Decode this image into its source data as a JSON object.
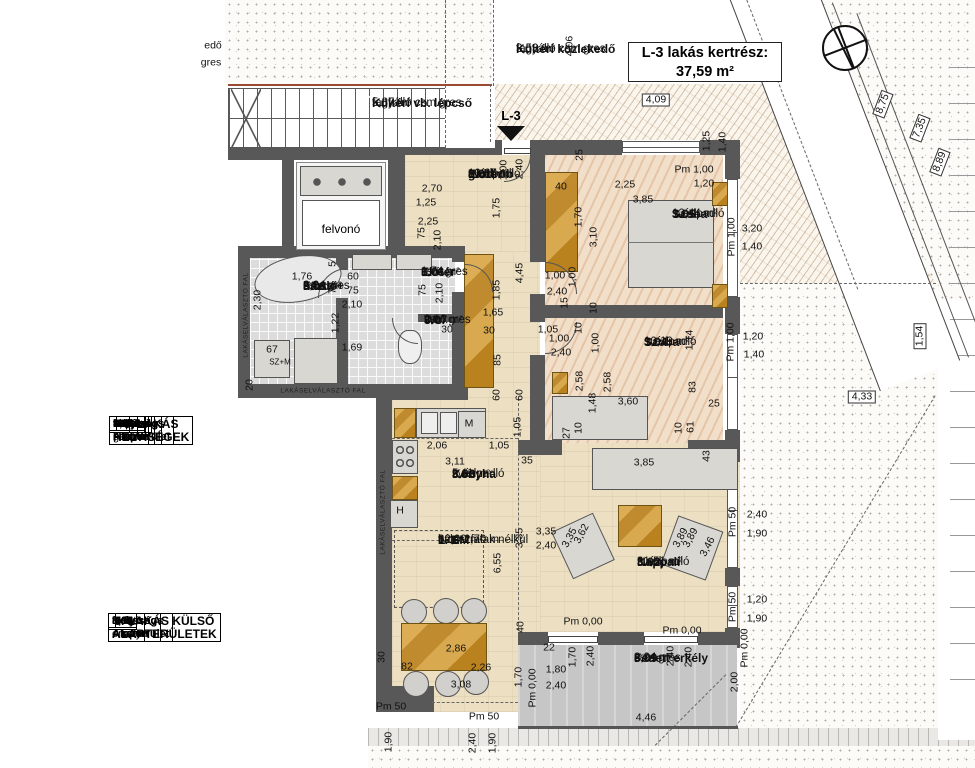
{
  "drawing": {
    "title_box": {
      "line1": "L-3 lakás kertrész:",
      "line2": "37,59 m²"
    },
    "entry_label": "L-3",
    "elevator_label": "felvonó"
  },
  "room_labels": [
    {
      "x": 516,
      "y": 42,
      "bg": 1,
      "lines": [
        [
          "Kültéri közlekedő",
          1
        ],
        [
          "fagyálló csm.gres",
          0
        ],
        [
          "3,53 m²",
          0
        ]
      ]
    },
    {
      "x": 372,
      "y": 96,
      "bg": 1,
      "lines": [
        [
          "Kültéri vb. lépcső",
          1
        ],
        [
          "fagyálló csm.gres",
          0
        ],
        [
          "5,87 m²",
          0
        ]
      ]
    },
    {
      "x": 468,
      "y": 168,
      "bg": 0,
      "lines": [
        [
          "3.01",
          1
        ],
        [
          "Előtér-",
          1
        ],
        [
          "gardrób",
          1
        ],
        [
          "svédpadló",
          0
        ],
        [
          "10,67 m²",
          0
        ]
      ]
    },
    {
      "x": 672,
      "y": 208,
      "bg": 0,
      "lines": [
        [
          "3.05",
          1
        ],
        [
          "Szoba",
          1
        ],
        [
          "svédpadló",
          0
        ],
        [
          "12,44 m²",
          0
        ]
      ]
    },
    {
      "x": 644,
      "y": 336,
      "bg": 0,
      "lines": [
        [
          "3.04",
          1
        ],
        [
          "Szoba",
          1
        ],
        [
          "svédpadló",
          0
        ],
        [
          "10,19 m²",
          0
        ]
      ]
    },
    {
      "x": 303,
      "y": 280,
      "bg": 0,
      "lines": [
        [
          "3.08",
          1
        ],
        [
          "Fürdő+",
          1
        ],
        [
          "házt.",
          1
        ],
        [
          "csm.gres",
          0
        ],
        [
          "6,64 m²",
          0
        ]
      ]
    },
    {
      "x": 421,
      "y": 266,
      "bg": 0,
      "lines": [
        [
          "3.06",
          1
        ],
        [
          "Előtér",
          1
        ],
        [
          "csm.gres",
          0
        ],
        [
          "1,74 m²",
          0
        ]
      ]
    },
    {
      "x": 424,
      "y": 314,
      "bg": 0,
      "lines": [
        [
          "3.07",
          1
        ],
        [
          "Wc",
          1
        ],
        [
          "csm.gres",
          0
        ],
        [
          "2,16 m²",
          0
        ]
      ]
    },
    {
      "x": 452,
      "y": 468,
      "bg": 0,
      "lines": [
        [
          "3.03",
          1
        ],
        [
          "Konyha",
          1
        ],
        [
          "svédpadló",
          0
        ],
        [
          "5,11 m²",
          0
        ]
      ]
    },
    {
      "x": 637,
      "y": 556,
      "bg": 0,
      "lines": [
        [
          "3.02",
          1
        ],
        [
          "Nappali",
          1
        ],
        [
          "svédpadló",
          0
        ],
        [
          "31,51 m²",
          0
        ]
      ]
    },
    {
      "x": 634,
      "y": 652,
      "bg": 0,
      "lines": [
        [
          "3.09",
          1
        ],
        [
          "Fedett erkély",
          1
        ],
        [
          "csm.gres",
          0
        ],
        [
          "8,94 m²",
          0
        ]
      ]
    },
    {
      "x": 438,
      "y": 534,
      "bg": 0,
      "lines": [
        [
          "1. EM",
          1
        ],
        [
          "L-3",
          1
        ],
        [
          "válaszfalak nélkül",
          0
        ],
        [
          "82,99 m²",
          0
        ],
        [
          "bm= 2,70 m",
          0
        ]
      ]
    }
  ],
  "dims": [
    [
      "edő",
      213,
      46,
      "h"
    ],
    [
      "gres",
      211,
      63,
      "h"
    ],
    [
      "4,09",
      656,
      100,
      "hb"
    ],
    [
      "4,06",
      570,
      46,
      "v"
    ],
    [
      "1,25",
      707,
      141,
      "v"
    ],
    [
      "1,40",
      723,
      142,
      "v"
    ],
    [
      "Pm 1,00",
      694,
      170,
      "h"
    ],
    [
      "2,25",
      625,
      185,
      "h"
    ],
    [
      "1,20",
      704,
      184,
      "h"
    ],
    [
      "40",
      561,
      187,
      "h"
    ],
    [
      "3,85",
      643,
      200,
      "h"
    ],
    [
      "3,20",
      752,
      229,
      "h"
    ],
    [
      "1,40",
      752,
      247,
      "h"
    ],
    [
      "25",
      580,
      155,
      "v"
    ],
    [
      "1,00",
      504,
      170,
      "v"
    ],
    [
      "2,40",
      520,
      169,
      "v"
    ],
    [
      "1,75",
      497,
      208,
      "v"
    ],
    [
      "2,70",
      432,
      189,
      "h"
    ],
    [
      "1,25",
      426,
      203,
      "h"
    ],
    [
      "2,25",
      428,
      222,
      "h"
    ],
    [
      "75",
      422,
      233,
      "v"
    ],
    [
      "2,10",
      438,
      240,
      "v"
    ],
    [
      "1,70",
      579,
      217,
      "v"
    ],
    [
      "3,10",
      594,
      237,
      "v"
    ],
    [
      "Pm 1,00",
      732,
      237,
      "v"
    ],
    [
      "1,00",
      555,
      276,
      "h"
    ],
    [
      "2,40",
      557,
      292,
      "h"
    ],
    [
      "1,00",
      573,
      277,
      "v"
    ],
    [
      "15",
      565,
      303,
      "v"
    ],
    [
      "10",
      594,
      308,
      "v"
    ],
    [
      "1,76",
      302,
      277,
      "h"
    ],
    [
      "60",
      353,
      277,
      "h"
    ],
    [
      "75",
      353,
      291,
      "h"
    ],
    [
      "2,10",
      352,
      305,
      "h"
    ],
    [
      "2,30",
      258,
      300,
      "v"
    ],
    [
      "5",
      333,
      264,
      "v"
    ],
    [
      "75",
      333,
      288,
      "v"
    ],
    [
      "1,22",
      336,
      323,
      "v"
    ],
    [
      "20",
      250,
      385,
      "v"
    ],
    [
      "67",
      272,
      350,
      "h"
    ],
    [
      "SZ+M",
      280,
      362,
      "sm"
    ],
    [
      "1,69",
      352,
      348,
      "h"
    ],
    [
      "75",
      423,
      290,
      "v"
    ],
    [
      "2,10",
      440,
      293,
      "v"
    ],
    [
      "30",
      447,
      330,
      "h"
    ],
    [
      "4,45",
      520,
      273,
      "v"
    ],
    [
      "1,85",
      497,
      290,
      "v"
    ],
    [
      "1,65",
      493,
      313,
      "h"
    ],
    [
      "30",
      489,
      331,
      "h"
    ],
    [
      "85",
      498,
      360,
      "v"
    ],
    [
      "60",
      497,
      395,
      "v"
    ],
    [
      "60",
      520,
      395,
      "v"
    ],
    [
      "1,05",
      518,
      427,
      "v"
    ],
    [
      "1,05",
      548,
      330,
      "h"
    ],
    [
      "1,00",
      559,
      339,
      "h"
    ],
    [
      "2,40",
      561,
      353,
      "h"
    ],
    [
      "10",
      579,
      328,
      "v"
    ],
    [
      "1,00",
      596,
      343,
      "v"
    ],
    [
      "2,58",
      580,
      381,
      "v"
    ],
    [
      "2,58",
      608,
      382,
      "v"
    ],
    [
      "1,48",
      593,
      403,
      "v"
    ],
    [
      "3,60",
      628,
      402,
      "h"
    ],
    [
      "1,14",
      690,
      340,
      "v"
    ],
    [
      "83",
      693,
      387,
      "v"
    ],
    [
      "25",
      714,
      404,
      "h"
    ],
    [
      "1,20",
      753,
      337,
      "h"
    ],
    [
      "1,40",
      754,
      355,
      "h"
    ],
    [
      "Pm 1,00",
      731,
      342,
      "v"
    ],
    [
      "27",
      567,
      433,
      "v"
    ],
    [
      "10",
      579,
      428,
      "v"
    ],
    [
      "10",
      679,
      428,
      "v"
    ],
    [
      "61",
      691,
      427,
      "v"
    ],
    [
      "43",
      707,
      456,
      "v"
    ],
    [
      "2,06",
      437,
      446,
      "h"
    ],
    [
      "1,05",
      499,
      446,
      "h"
    ],
    [
      "3,11",
      455,
      462,
      "h"
    ],
    [
      "35",
      527,
      461,
      "h"
    ],
    [
      "M",
      469,
      424,
      "h"
    ],
    [
      "H",
      400,
      511,
      "h"
    ],
    [
      "3,85",
      644,
      463,
      "h"
    ],
    [
      "3,35",
      546,
      532,
      "h"
    ],
    [
      "2,40",
      546,
      546,
      "h"
    ],
    [
      "3,35",
      520,
      538,
      "v"
    ],
    [
      "6,55",
      498,
      563,
      "v"
    ],
    [
      "3,35",
      570,
      538,
      "a"
    ],
    [
      "3,62",
      582,
      534,
      "a"
    ],
    [
      "3,89",
      681,
      538,
      "a"
    ],
    [
      "3,89",
      691,
      538,
      "a"
    ],
    [
      "3,46",
      708,
      547,
      "a"
    ],
    [
      "Pm 50",
      733,
      522,
      "v"
    ],
    [
      "2,40",
      757,
      515,
      "h"
    ],
    [
      "1,90",
      757,
      534,
      "h"
    ],
    [
      "Pm 50",
      733,
      607,
      "v"
    ],
    [
      "1,20",
      757,
      600,
      "h"
    ],
    [
      "1,90",
      757,
      619,
      "h"
    ],
    [
      "Pm 0,00",
      583,
      622,
      "h"
    ],
    [
      "Pm 0,00",
      682,
      631,
      "h"
    ],
    [
      "2,86",
      456,
      649,
      "h"
    ],
    [
      "82",
      407,
      667,
      "h"
    ],
    [
      "2,26",
      481,
      668,
      "h"
    ],
    [
      "3,08",
      461,
      685,
      "h"
    ],
    [
      "30",
      382,
      657,
      "v"
    ],
    [
      "Pm 50",
      391,
      707,
      "h"
    ],
    [
      "Pm 50",
      484,
      717,
      "h"
    ],
    [
      "40",
      521,
      627,
      "v"
    ],
    [
      "22",
      549,
      648,
      "h"
    ],
    [
      "1,70",
      573,
      657,
      "v"
    ],
    [
      "2,40",
      591,
      656,
      "v"
    ],
    [
      "1,80",
      556,
      670,
      "h"
    ],
    [
      "2,40",
      556,
      686,
      "h"
    ],
    [
      "1,70",
      519,
      677,
      "v"
    ],
    [
      "Pm 0,00",
      533,
      688,
      "v"
    ],
    [
      "2,40",
      671,
      656,
      "v"
    ],
    [
      "2,40",
      689,
      657,
      "v"
    ],
    [
      "2,00",
      735,
      682,
      "v"
    ],
    [
      "4,46",
      646,
      718,
      "h"
    ],
    [
      "Pm 0,00",
      745,
      648,
      "v"
    ],
    [
      "1,90",
      389,
      742,
      "v"
    ],
    [
      "2,40",
      473,
      743,
      "v"
    ],
    [
      "1,90",
      493,
      743,
      "v"
    ],
    [
      "4,33",
      862,
      397,
      "hb"
    ],
    [
      "1,54",
      920,
      336,
      "vb"
    ],
    [
      "8,75",
      883,
      104,
      "d"
    ],
    [
      "7,35",
      920,
      128,
      "d"
    ],
    [
      "8,89",
      940,
      162,
      "d"
    ],
    [
      "LAKÁSELVÁLASZTÓ FAL",
      246,
      315,
      "wv"
    ],
    [
      "LAKÁSELVÁLASZTÓ FAL",
      323,
      391,
      "wh"
    ],
    [
      "LAKÁSELVÁLASZTÓ FAL",
      383,
      512,
      "wv"
    ]
  ],
  "tables": {
    "rooms_table": {
      "title": "3. LAKÁS HELYISÉGEK",
      "headers": [
        "Helyiség szám",
        "Helyiség neve",
        "Hasznos Alapterület"
      ],
      "rows": [
        [
          "3.01",
          "előtér- gardrób",
          "10,67"
        ],
        [
          "3.02",
          "nappali",
          "31,51"
        ],
        [
          "3.03",
          "konyha",
          "5,11"
        ],
        [
          "3.04",
          "szoba",
          "10,19"
        ],
        [
          "3.05",
          "szoba",
          "12,44"
        ],
        [
          "3.06",
          "előtér",
          "1,74"
        ],
        [
          "3.07",
          "wc",
          "2,16"
        ],
        [
          "3.08",
          "fürdő+ házt.",
          "6,64"
        ]
      ],
      "total": "80,46 m²"
    },
    "outdoor_table": {
      "title": "3. LAKÁS KÜLSŐ ALAPTERÜLETEK",
      "headers": [
        "Helyiség szám",
        "Helyiség neve",
        "Hasznos Alapterület"
      ],
      "rows": [
        [
          "3.08",
          "fedett erkély",
          "8,94"
        ]
      ],
      "total": "8,94 m²"
    }
  }
}
